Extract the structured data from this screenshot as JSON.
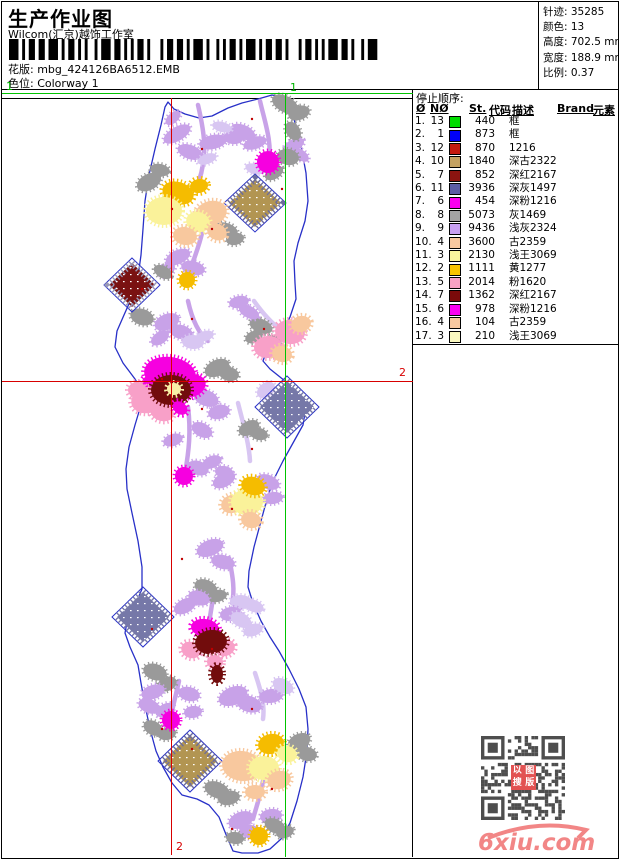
{
  "header": {
    "title": "生产作业图",
    "subtitle": "Wilcom(汇京)越饰工作室",
    "pattern_label": "花版:",
    "pattern_value": "mbg_424126BA6512.EMB",
    "colorway_label": "色位:",
    "colorway_value": "Colorway 1"
  },
  "info_box": {
    "rows": [
      {
        "label": "针迹:",
        "value": "35285"
      },
      {
        "label": "颜色:",
        "value": "13"
      },
      {
        "label": "高度:",
        "value": "702.5 mm"
      },
      {
        "label": "宽度:",
        "value": "188.9 mm"
      },
      {
        "label": "比例:",
        "value": "0.37"
      }
    ]
  },
  "guides": {
    "green": {
      "label": "1",
      "color": "#00C400"
    },
    "red": {
      "label": "2",
      "color": "#D80000"
    }
  },
  "thread_table": {
    "title": "停止顺序:",
    "columns": [
      "Ø",
      "NØ",
      "St.",
      "代码",
      "描述",
      "Brand",
      "元素"
    ],
    "rows": [
      {
        "seq": "1.",
        "no": "13",
        "color": "#00DC00",
        "st": "440",
        "code": "",
        "desc": "框",
        "brand": "",
        "element": ""
      },
      {
        "seq": "2.",
        "no": "1",
        "color": "#0000F8",
        "st": "873",
        "code": "",
        "desc": "框",
        "brand": "",
        "element": ""
      },
      {
        "seq": "3.",
        "no": "12",
        "color": "#C41A10",
        "st": "870",
        "code": "",
        "desc": "1216",
        "brand": "",
        "element": ""
      },
      {
        "seq": "4.",
        "no": "10",
        "color": "#C4A262",
        "st": "1840",
        "code": "",
        "desc": "深古2322",
        "brand": "",
        "element": ""
      },
      {
        "seq": "5.",
        "no": "7",
        "color": "#8B1410",
        "st": "852",
        "code": "",
        "desc": "深红2167",
        "brand": "",
        "element": ""
      },
      {
        "seq": "6.",
        "no": "11",
        "color": "#5C5CA4",
        "st": "3936",
        "code": "",
        "desc": "深灰1497",
        "brand": "",
        "element": ""
      },
      {
        "seq": "7.",
        "no": "6",
        "color": "#FA00F0",
        "st": "454",
        "code": "",
        "desc": "深粉1216",
        "brand": "",
        "element": ""
      },
      {
        "seq": "8.",
        "no": "8",
        "color": "#A4A4A4",
        "st": "5073",
        "code": "",
        "desc": "灰1469",
        "brand": "",
        "element": ""
      },
      {
        "seq": "9.",
        "no": "9",
        "color": "#C8A0F2",
        "st": "9436",
        "code": "",
        "desc": "浅灰2324",
        "brand": "",
        "element": ""
      },
      {
        "seq": "10.",
        "no": "4",
        "color": "#F8C8A0",
        "st": "3600",
        "code": "",
        "desc": "古2359",
        "brand": "",
        "element": ""
      },
      {
        "seq": "11.",
        "no": "3",
        "color": "#FAF69E",
        "st": "2130",
        "code": "",
        "desc": "浅王3069",
        "brand": "",
        "element": ""
      },
      {
        "seq": "12.",
        "no": "2",
        "color": "#F8C400",
        "st": "1111",
        "code": "",
        "desc": "黄1277",
        "brand": "",
        "element": ""
      },
      {
        "seq": "13.",
        "no": "5",
        "color": "#F8A2C4",
        "st": "2014",
        "code": "",
        "desc": "粉1620",
        "brand": "",
        "element": ""
      },
      {
        "seq": "14.",
        "no": "7",
        "color": "#7A0A0A",
        "st": "1362",
        "code": "",
        "desc": "深红2167",
        "brand": "",
        "element": ""
      },
      {
        "seq": "15.",
        "no": "6",
        "color": "#FA00F0",
        "st": "978",
        "code": "",
        "desc": "深粉1216",
        "brand": "",
        "element": ""
      },
      {
        "seq": "16.",
        "no": "4",
        "color": "#F8C8A0",
        "st": "104",
        "code": "",
        "desc": "古2359",
        "brand": "",
        "element": ""
      },
      {
        "seq": "17.",
        "no": "3",
        "color": "#FAF8C0",
        "st": "210",
        "code": "",
        "desc": "浅王3069",
        "brand": "",
        "element": ""
      }
    ]
  },
  "design": {
    "outline_color": "#2830C8"
  },
  "footer": {
    "watermark": "6xiu.com",
    "watermark_color": "#F28686",
    "qr_seal_text": "以图搜版"
  }
}
